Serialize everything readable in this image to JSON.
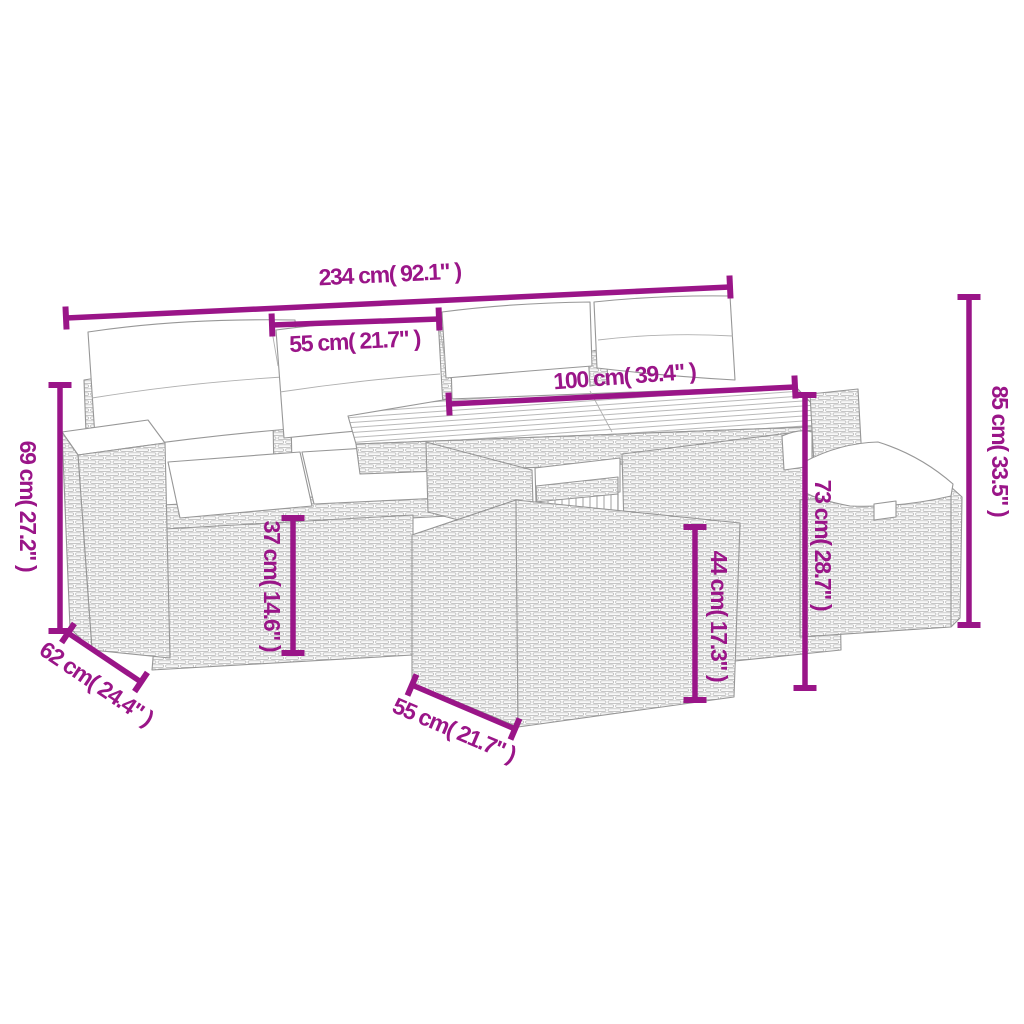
{
  "diagram": {
    "illustration_alt": "Line drawing of a 6-piece rattan garden lounge set with back cushions, seat cushions, table and footstool",
    "accent_color": "#9A1588",
    "line_color": "#979797",
    "background_color": "#ffffff",
    "measurements": [
      {
        "id": "total-width",
        "label": "234 cm( 92.1\" )",
        "x1": 66,
        "y1": 318,
        "x2": 730,
        "y2": 287,
        "lx": 390,
        "ly": 282,
        "rot": -2.7
      },
      {
        "id": "cushion-width",
        "label": "55 cm( 21.7\" )",
        "x1": 272,
        "y1": 325,
        "x2": 439,
        "y2": 319,
        "lx": 355,
        "ly": 349,
        "rot": -2.7
      },
      {
        "id": "table-width",
        "label": "100 cm( 39.4\" )",
        "x1": 449,
        "y1": 404,
        "x2": 795,
        "y2": 387,
        "lx": 625,
        "ly": 384,
        "rot": -4.3
      },
      {
        "id": "total-height",
        "label": "85 cm( 33.5\" )",
        "x1": 969,
        "y1": 297,
        "x2": 969,
        "y2": 625,
        "lx": 992,
        "ly": 451,
        "rot": 90
      },
      {
        "id": "back-height",
        "label": "69 cm( 27.2\" )",
        "x1": 60,
        "y1": 385,
        "x2": 60,
        "y2": 631,
        "lx": 20,
        "ly": 506,
        "rot": 90
      },
      {
        "id": "seat-depth",
        "label": "62 cm( 24.4\" )",
        "x1": 68,
        "y1": 633,
        "x2": 141,
        "y2": 682,
        "lx": 92,
        "ly": 690,
        "rot": 34
      },
      {
        "id": "seat-height",
        "label": "37 cm( 14.6\" )",
        "x1": 293,
        "y1": 518,
        "x2": 293,
        "y2": 653,
        "lx": 264,
        "ly": 586,
        "rot": 90
      },
      {
        "id": "stool-height",
        "label": "44 cm( 17.3\" )",
        "x1": 695,
        "y1": 527,
        "x2": 695,
        "y2": 700,
        "lx": 711,
        "ly": 616,
        "rot": 90
      },
      {
        "id": "table-height",
        "label": "73 cm( 28.7\" )",
        "x1": 805,
        "y1": 395,
        "x2": 805,
        "y2": 688,
        "lx": 815,
        "ly": 545,
        "rot": 90
      },
      {
        "id": "stool-width",
        "label": "55 cm( 21.7\" )",
        "x1": 412,
        "y1": 685,
        "x2": 515,
        "y2": 729,
        "lx": 451,
        "ly": 737,
        "rot": 23
      }
    ]
  }
}
